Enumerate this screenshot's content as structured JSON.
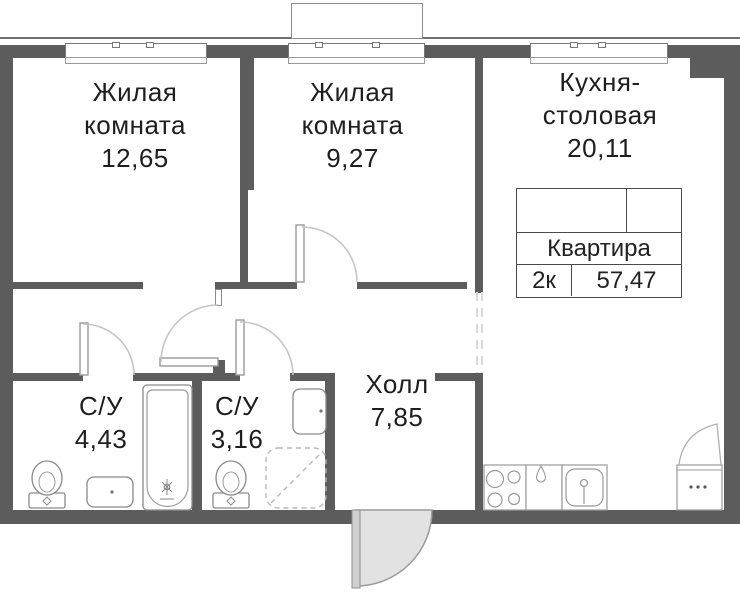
{
  "plan": {
    "rooms": [
      {
        "id": "living-room-1",
        "line1": "Жилая",
        "line2": "комната",
        "area": "12,65"
      },
      {
        "id": "living-room-2",
        "line1": "Жилая",
        "line2": "комната",
        "area": "9,27"
      },
      {
        "id": "kitchen-dining",
        "line1": "Кухня-",
        "line2": "столовая",
        "area": "20,11"
      },
      {
        "id": "bathroom-1",
        "line1": "С/У",
        "area": "4,43"
      },
      {
        "id": "bathroom-2",
        "line1": "С/У",
        "area": "3,16"
      },
      {
        "id": "hall",
        "line1": "Холл",
        "area": "7,85"
      }
    ],
    "info_table": {
      "title": "Квартира",
      "type": "2к",
      "total_area": "57,47"
    },
    "colors": {
      "wall": "#5c5c5c",
      "fixture_line": "#8a8a8a",
      "door_arc": "#c6c6c6",
      "entrance_door_fill": "#e2e2e2",
      "dashed_opening": "#d9d9d9",
      "text": "#1e1e1e"
    }
  }
}
